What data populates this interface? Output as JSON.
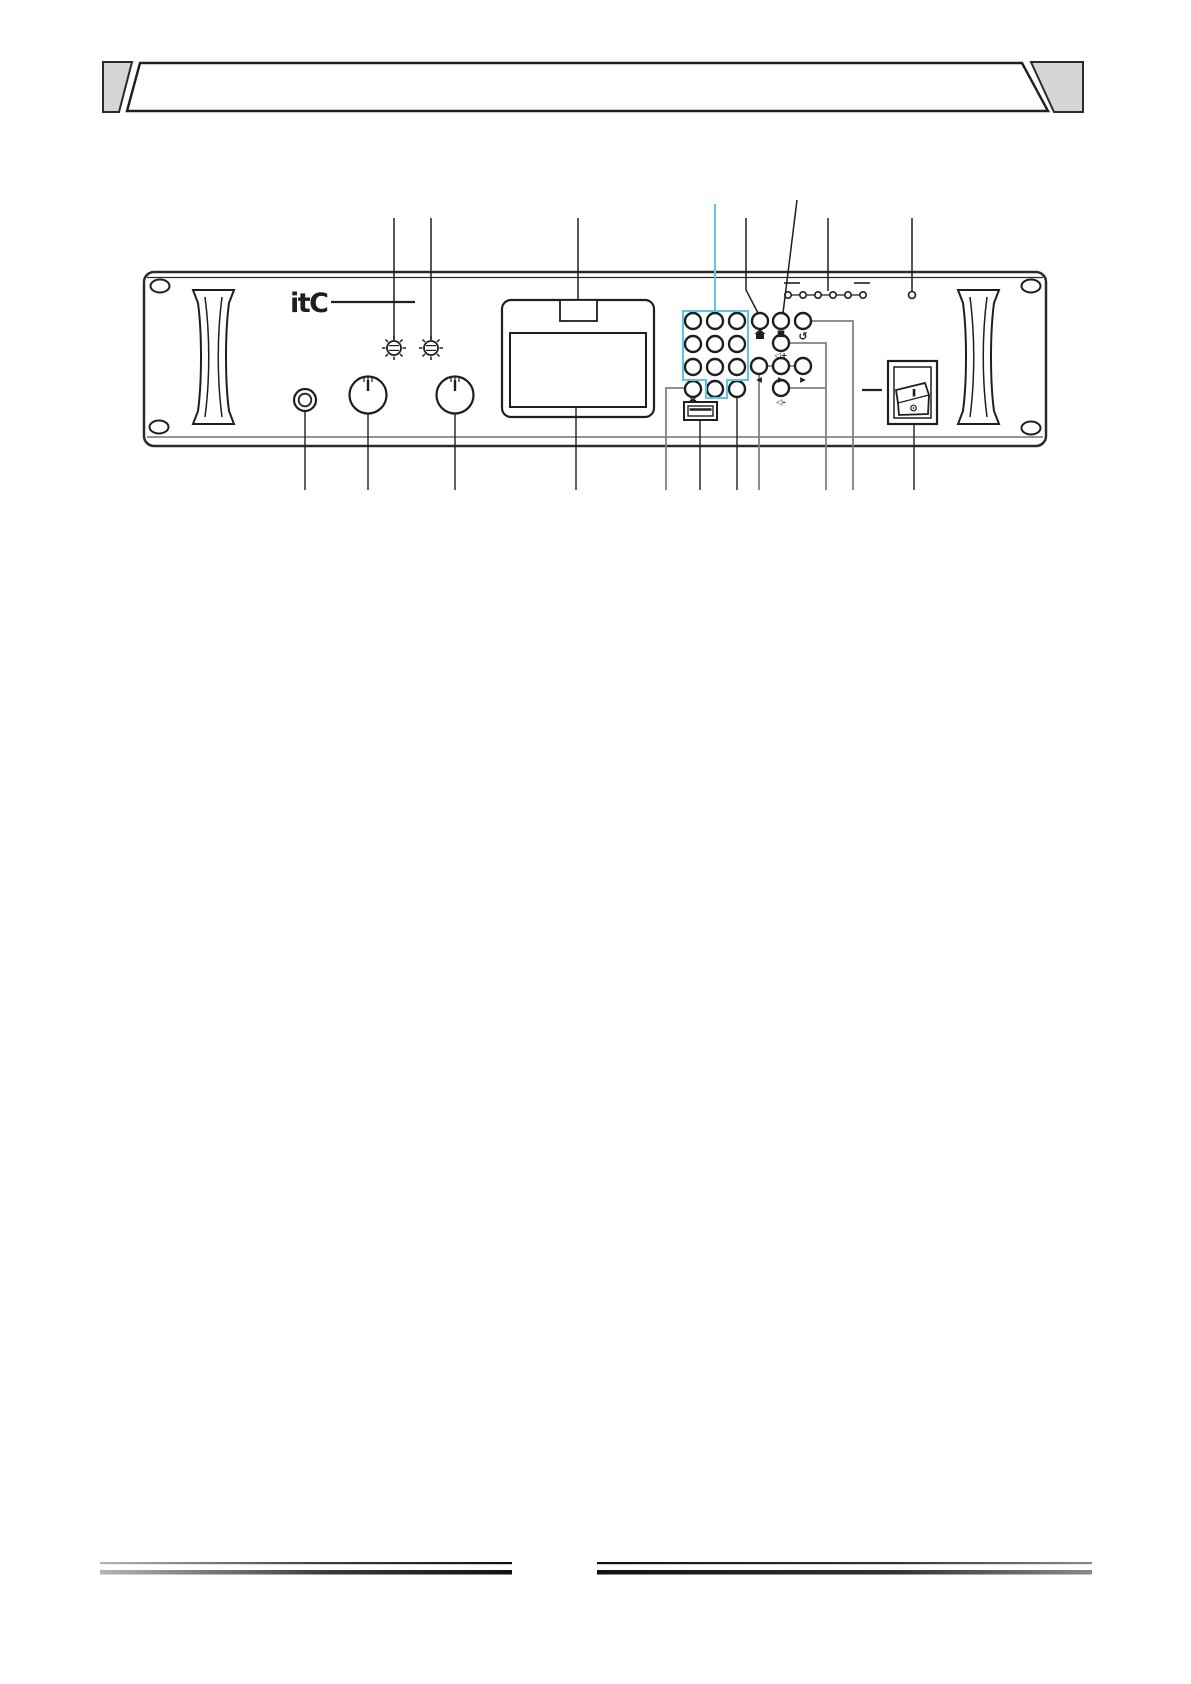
{
  "page": {
    "background": "#ffffff",
    "kind": "product-manual-diagram-page"
  },
  "brand_logo": "itC",
  "colors": {
    "accent_cyan": "#5bc6e8",
    "panel_line": "#2b2b2b",
    "gray_callout": "#818181",
    "header_gray": "#d6d6d6",
    "footer_dark": "#141414"
  },
  "front_panel": {
    "keypad": {
      "rows": 4,
      "cols": 3,
      "button_count": 12,
      "highlight_outline_color": "#5bc6e8"
    },
    "nav_icons": {
      "home": "home-icon",
      "stop": "stop-icon",
      "return": "↺",
      "vol_up": "◁+",
      "prev": "◀",
      "play": "▶",
      "next": "▶",
      "vol_down": "◁-",
      "asterisk": "asterisk-icon"
    },
    "indicator_led_count": 6,
    "single_indicator_count": 1,
    "power_switch": {
      "on_label": "I",
      "off_mark": "circle-dot-icon"
    },
    "ports": [
      "mic-jack",
      "usb-port"
    ],
    "knob_count": 2,
    "trimmer_count": 2
  }
}
